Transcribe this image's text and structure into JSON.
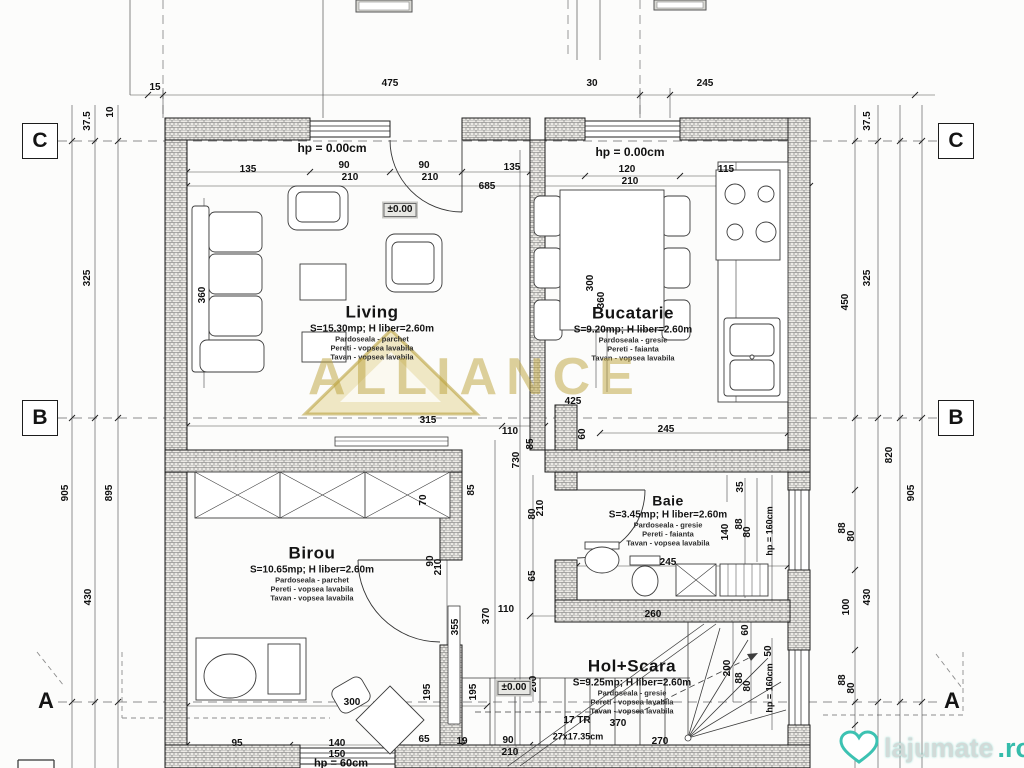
{
  "watermarks": {
    "brand": "ALLIANCE",
    "site_name": "lajumate",
    "site_tld": ".ro"
  },
  "grid": {
    "rows": [
      "C",
      "B",
      "A"
    ]
  },
  "rooms": [
    {
      "name": "Living",
      "area": "S=15.30mp; H liber=2.60m",
      "finishes": [
        "Pardoseala - parchet",
        "Pereti - vopsea lavabila",
        "Tavan - vopsea lavabila"
      ]
    },
    {
      "name": "Bucatarie",
      "area": "S=9.20mp; H liber=2.60m",
      "finishes": [
        "Pardoseala - gresie",
        "Pereti - faianta",
        "Tavan - vopsea lavabila"
      ]
    },
    {
      "name": "Baie",
      "area": "S=3.45mp; H liber=2.60m",
      "finishes": [
        "Pardoseala - gresie",
        "Pereti - faianta",
        "Tavan - vopsea lavabila"
      ]
    },
    {
      "name": "Birou",
      "area": "S=10.65mp; H liber=2.60m",
      "finishes": [
        "Pardoseala - parchet",
        "Pereti - vopsea lavabila",
        "Tavan - vopsea lavabila"
      ]
    },
    {
      "name": "Hol+Scara",
      "area": "S=9.25mp; H liber=2.60m",
      "finishes": [
        "Pardoseala - gresie",
        "Pereti - vopsea lavabila",
        "Tavan - vopsea lavabila"
      ]
    }
  ],
  "dim_labels": [
    {
      "t": "15",
      "x": 155,
      "y": 88
    },
    {
      "t": "475",
      "x": 390,
      "y": 84
    },
    {
      "t": "30",
      "x": 592,
      "y": 84
    },
    {
      "t": "245",
      "x": 705,
      "y": 84
    },
    {
      "t": "37.5",
      "x": 88,
      "y": 121,
      "r": 1
    },
    {
      "t": "10",
      "x": 111,
      "y": 112,
      "r": 1
    },
    {
      "t": "325",
      "x": 88,
      "y": 278,
      "r": 1
    },
    {
      "t": "905",
      "x": 66,
      "y": 493,
      "r": 1
    },
    {
      "t": "895",
      "x": 110,
      "y": 493,
      "r": 1
    },
    {
      "t": "430",
      "x": 89,
      "y": 597,
      "r": 1
    },
    {
      "t": "37.5",
      "x": 868,
      "y": 121,
      "r": 1
    },
    {
      "t": "325",
      "x": 868,
      "y": 278,
      "r": 1
    },
    {
      "t": "450",
      "x": 846,
      "y": 302,
      "r": 1
    },
    {
      "t": "820",
      "x": 890,
      "y": 455,
      "r": 1
    },
    {
      "t": "905",
      "x": 912,
      "y": 493,
      "r": 1
    },
    {
      "t": "88",
      "x": 843,
      "y": 528,
      "r": 1
    },
    {
      "t": "80",
      "x": 852,
      "y": 536,
      "r": 1
    },
    {
      "t": "430",
      "x": 868,
      "y": 597,
      "r": 1
    },
    {
      "t": "100",
      "x": 847,
      "y": 607,
      "r": 1
    },
    {
      "t": "88",
      "x": 843,
      "y": 680,
      "r": 1
    },
    {
      "t": "80",
      "x": 852,
      "y": 688,
      "r": 1
    },
    {
      "t": "hp = 0.00cm",
      "x": 332,
      "y": 148,
      "s": 12
    },
    {
      "t": "135",
      "x": 248,
      "y": 170
    },
    {
      "t": "90",
      "x": 344,
      "y": 166
    },
    {
      "t": "210",
      "x": 350,
      "y": 178
    },
    {
      "t": "90",
      "x": 424,
      "y": 166
    },
    {
      "t": "210",
      "x": 430,
      "y": 178
    },
    {
      "t": "685",
      "x": 487,
      "y": 187
    },
    {
      "t": "135",
      "x": 512,
      "y": 168
    },
    {
      "t": "±0.00",
      "x": 400,
      "y": 210,
      "box": 1
    },
    {
      "t": "360",
      "x": 203,
      "y": 295,
      "r": 1
    },
    {
      "t": "hp = 0.00cm",
      "x": 630,
      "y": 152,
      "s": 12
    },
    {
      "t": "120",
      "x": 627,
      "y": 170
    },
    {
      "t": "210",
      "x": 630,
      "y": 182
    },
    {
      "t": "115",
      "x": 726,
      "y": 170
    },
    {
      "t": "300",
      "x": 591,
      "y": 283,
      "r": 1
    },
    {
      "t": "360",
      "x": 602,
      "y": 300,
      "r": 1
    },
    {
      "t": "425",
      "x": 573,
      "y": 402
    },
    {
      "t": "315",
      "x": 428,
      "y": 421
    },
    {
      "t": "110",
      "x": 510,
      "y": 432
    },
    {
      "t": "85",
      "x": 531,
      "y": 444,
      "r": 1
    },
    {
      "t": "730",
      "x": 517,
      "y": 460,
      "r": 1
    },
    {
      "t": "60",
      "x": 583,
      "y": 434,
      "r": 1
    },
    {
      "t": "245",
      "x": 666,
      "y": 430
    },
    {
      "t": "85",
      "x": 472,
      "y": 490,
      "r": 1
    },
    {
      "t": "35",
      "x": 741,
      "y": 487,
      "r": 1
    },
    {
      "t": "140",
      "x": 726,
      "y": 532,
      "r": 1
    },
    {
      "t": "88",
      "x": 740,
      "y": 524,
      "r": 1
    },
    {
      "t": "80",
      "x": 748,
      "y": 532,
      "r": 1
    },
    {
      "t": "hp = 160cm",
      "x": 770,
      "y": 531,
      "r": 1,
      "s": 9
    },
    {
      "t": "245",
      "x": 668,
      "y": 563
    },
    {
      "t": "70",
      "x": 424,
      "y": 500,
      "r": 1
    },
    {
      "t": "90",
      "x": 431,
      "y": 561,
      "r": 1
    },
    {
      "t": "210",
      "x": 439,
      "y": 567,
      "r": 1
    },
    {
      "t": "195",
      "x": 428,
      "y": 692,
      "r": 1
    },
    {
      "t": "195",
      "x": 474,
      "y": 692,
      "r": 1
    },
    {
      "t": "355",
      "x": 456,
      "y": 627,
      "r": 1
    },
    {
      "t": "370",
      "x": 487,
      "y": 616,
      "r": 1
    },
    {
      "t": "110",
      "x": 506,
      "y": 610
    },
    {
      "t": "80",
      "x": 533,
      "y": 514,
      "r": 1
    },
    {
      "t": "210",
      "x": 541,
      "y": 508,
      "r": 1
    },
    {
      "t": "65",
      "x": 533,
      "y": 576,
      "r": 1
    },
    {
      "t": "200",
      "x": 534,
      "y": 684,
      "r": 1
    },
    {
      "t": "±0.00",
      "x": 514,
      "y": 688,
      "box": 1
    },
    {
      "t": "260",
      "x": 653,
      "y": 615
    },
    {
      "t": "60",
      "x": 746,
      "y": 630,
      "r": 1
    },
    {
      "t": "200",
      "x": 728,
      "y": 668,
      "r": 1
    },
    {
      "t": "88",
      "x": 740,
      "y": 678,
      "r": 1
    },
    {
      "t": "80",
      "x": 748,
      "y": 686,
      "r": 1
    },
    {
      "t": "hp = 160cm",
      "x": 770,
      "y": 688,
      "r": 1,
      "s": 9
    },
    {
      "t": "50",
      "x": 769,
      "y": 651,
      "r": 1
    },
    {
      "t": "17 TR",
      "x": 577,
      "y": 721
    },
    {
      "t": "370",
      "x": 618,
      "y": 724
    },
    {
      "t": "27x17.35cm",
      "x": 578,
      "y": 737,
      "s": 9
    },
    {
      "t": "270",
      "x": 660,
      "y": 742
    },
    {
      "t": "300",
      "x": 352,
      "y": 703
    },
    {
      "t": "95",
      "x": 237,
      "y": 744
    },
    {
      "t": "140",
      "x": 337,
      "y": 744
    },
    {
      "t": "150",
      "x": 337,
      "y": 755
    },
    {
      "t": "hp = 60cm",
      "x": 341,
      "y": 764,
      "s": 11
    },
    {
      "t": "65",
      "x": 424,
      "y": 740
    },
    {
      "t": "19",
      "x": 462,
      "y": 742
    },
    {
      "t": "90",
      "x": 508,
      "y": 741
    },
    {
      "t": "210",
      "x": 510,
      "y": 753
    }
  ]
}
